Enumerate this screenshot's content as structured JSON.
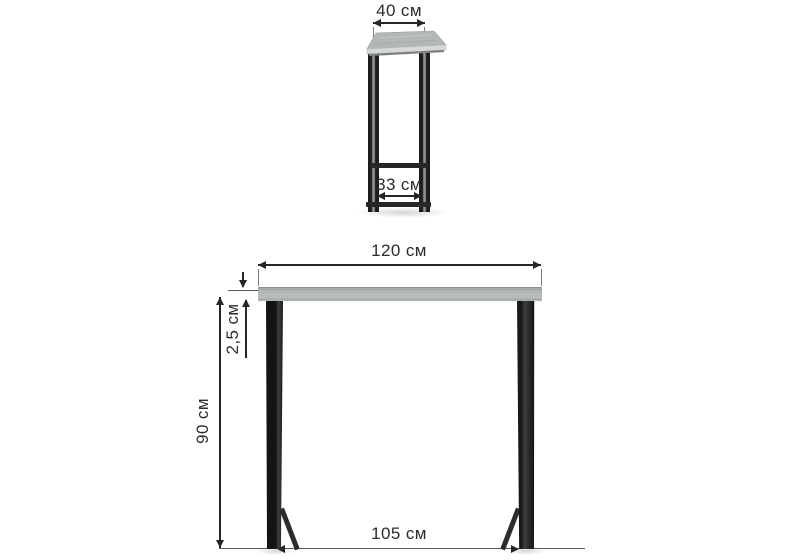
{
  "diagram": {
    "title": "Console bar table dimension drawing",
    "unit": "см",
    "views": {
      "side": {
        "labels": {
          "top_depth": "40 см",
          "inner_base_depth": "33 см"
        }
      },
      "front": {
        "labels": {
          "top_width": "120 см",
          "top_thickness": "2,5 см",
          "height": "90 см",
          "base_width": "105 см"
        }
      }
    },
    "dimensions": [
      {
        "part": "tabletop depth",
        "value": "40",
        "unit": "см"
      },
      {
        "part": "base inner depth",
        "value": "33",
        "unit": "см"
      },
      {
        "part": "tabletop width",
        "value": "120",
        "unit": "см"
      },
      {
        "part": "tabletop thickness",
        "value": "2,5",
        "unit": "см"
      },
      {
        "part": "height under top",
        "value": "90",
        "unit": "см"
      },
      {
        "part": "base width",
        "value": "105",
        "unit": "см"
      }
    ],
    "colors": {
      "background": "#ffffff",
      "tabletop_grey": "#b5b8b9",
      "metal_black": "#1f1f1f",
      "dimension_ink": "#262626"
    }
  }
}
